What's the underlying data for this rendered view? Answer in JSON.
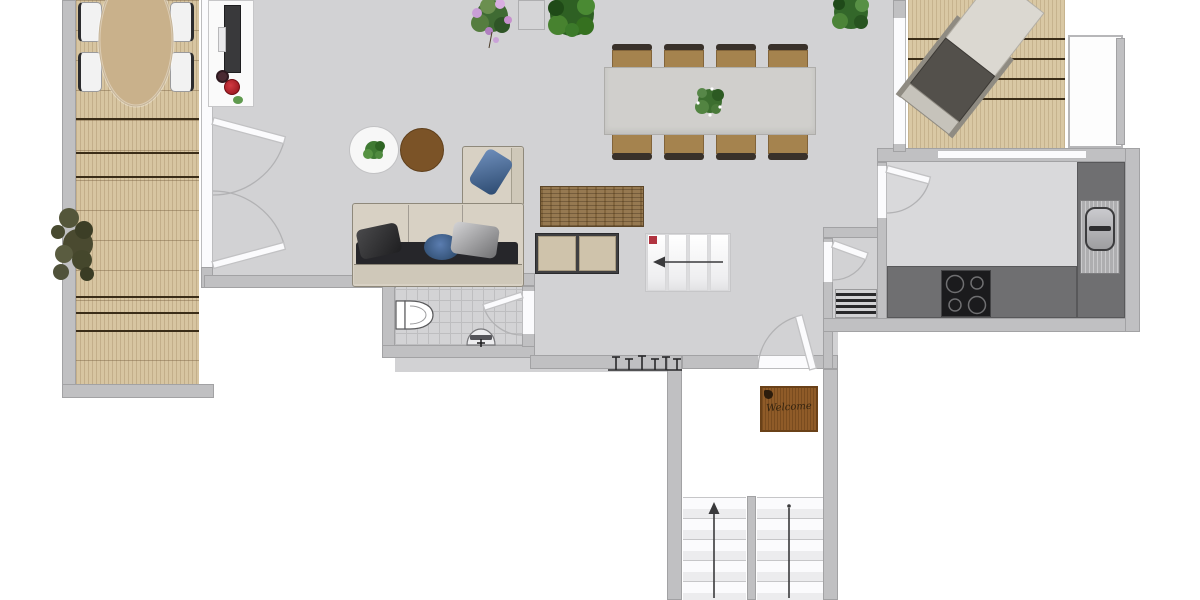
{
  "app": {
    "type": "floor-plan",
    "view": "top-down apartment main floor"
  },
  "welcome_mat": {
    "text": "Welcome"
  },
  "rooms": {
    "terrace_left": {
      "label": "left terrace",
      "furniture": [
        "oval-dining-table",
        "outdoor-chairs",
        "bush-plant"
      ],
      "chairs": 4
    },
    "living_dining": {
      "label": "living and dining room",
      "furniture": [
        "tv-sideboard",
        "sectional-sofa",
        "round-coffee-tables",
        "wood-lowboard",
        "two-door-cabinet",
        "dining-table",
        "pillar",
        "plants"
      ]
    },
    "dining": {
      "chairs_top": 4,
      "chairs_bottom": 4,
      "centerpiece": "plant"
    },
    "kitchen": {
      "label": "kitchen",
      "features": [
        "cooktop",
        "sink",
        "l-counter",
        "window",
        "door"
      ],
      "burners": 4
    },
    "bathroom": {
      "label": "wc",
      "features": [
        "toilet",
        "hand-basin",
        "tiled-floor",
        "door"
      ]
    },
    "hallway": {
      "label": "entry hall",
      "features": [
        "entry-door",
        "coat-rack",
        "welcome-mat",
        "radiator-grate",
        "storage-door"
      ],
      "coat_hooks": 6
    },
    "terrace_right": {
      "label": "right deck",
      "furniture": [
        "sun-lounger"
      ],
      "side_area": "light balcony nook"
    },
    "stairwell": {
      "label": "stairwell",
      "flights": 2,
      "direction": "up"
    }
  },
  "stairs": {
    "interior_steps": 4,
    "interior_arrow": "left",
    "interior_marker": "red-square",
    "stairwell_treads_per_flight": 5,
    "stairwell_arrow": "up"
  },
  "colors": {
    "floor": "#d2d2d4",
    "wall": "#c0c0c2",
    "deck_wood": "#d7c5a1",
    "counter": "#6f6f71",
    "cooktop": "#1b1b1d",
    "sofa": "#d8d1c4",
    "sofa_shadow": "#26262a",
    "pillow_blue": "#3f6398",
    "coffee_table_brown": "#7b5327",
    "dining_table": "#d0cfcc",
    "chair_tan": "#a5834e",
    "mat_brown": "#8f5b28",
    "plant_green": "#3c6e2f",
    "accent_red": "#b01822",
    "stairs_white": "#fbfbfd"
  }
}
